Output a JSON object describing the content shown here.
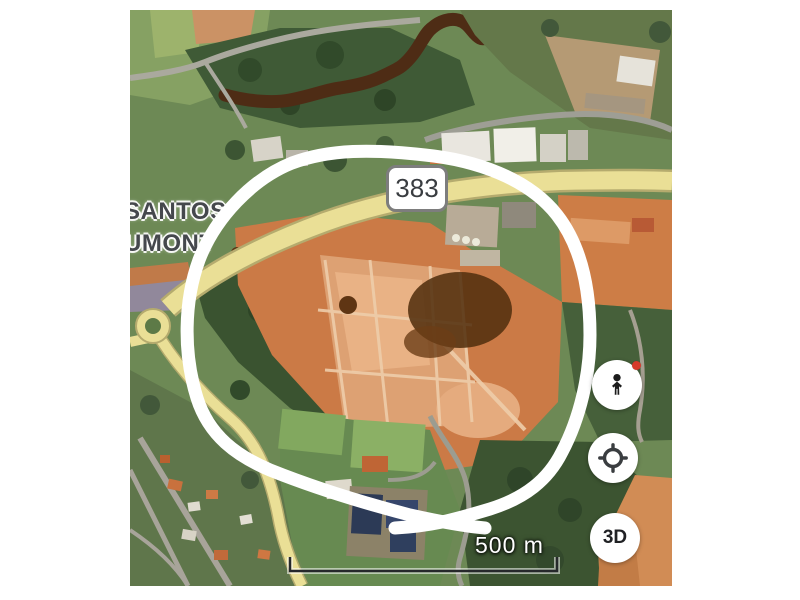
{
  "app": {
    "type": "satellite map screenshot with letterbox margins"
  },
  "map": {
    "place_label": {
      "line1": "SANTOS",
      "line2": "UMONT"
    },
    "route_shield": {
      "number": "383"
    },
    "scale_bar": {
      "label": "500 m",
      "length_px": 267
    },
    "controls": {
      "pegman": {
        "icon": "pegman-icon",
        "badge_color": "#d63a2a"
      },
      "my_location": {
        "icon": "my-location-icon"
      },
      "three_d": {
        "label": "3D"
      }
    },
    "annotation": {
      "shape": "hand-drawn white loop around construction site",
      "color": "#ffffff"
    },
    "colors": {
      "highway_yellow": "#eadf96",
      "dirt_orange": "#cb7a46",
      "forest_green": "#3a5330",
      "river_brown": "#4e2c15",
      "label_text": "#45484d",
      "shield_border": "#7d7d7d"
    }
  }
}
